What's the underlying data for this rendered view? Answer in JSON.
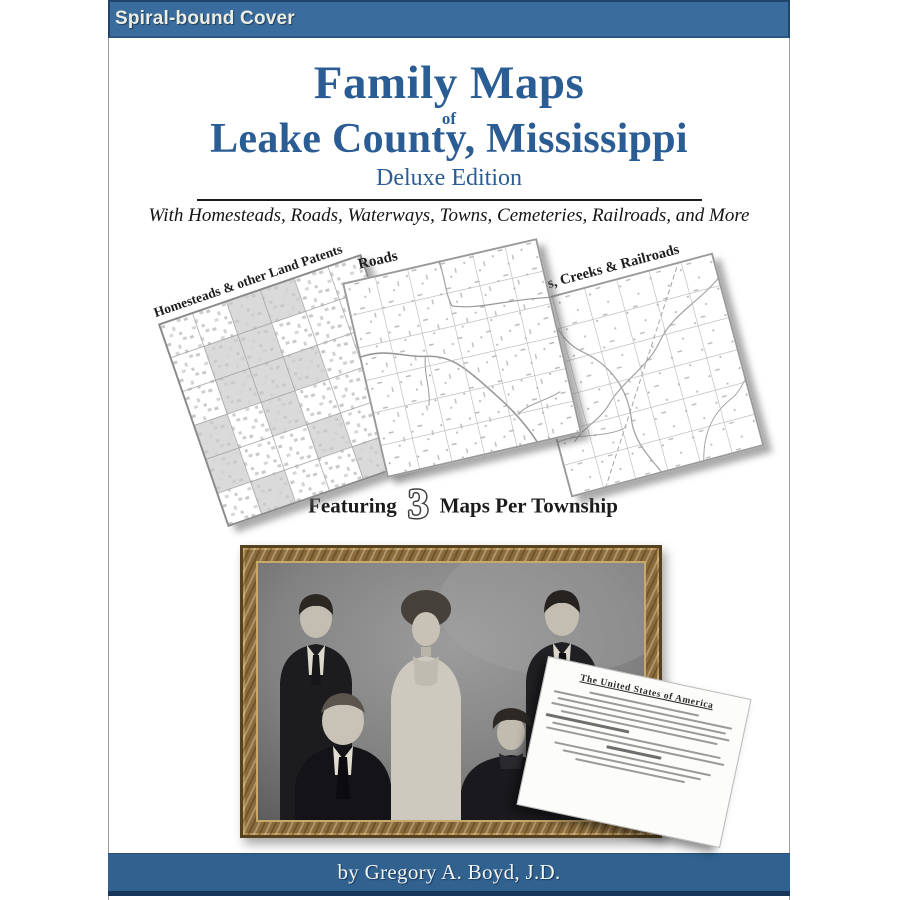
{
  "banner": {
    "label": "Spiral-bound Cover"
  },
  "cover": {
    "title": "Family Maps",
    "of": "of",
    "county": "Leake County, Mississippi",
    "edition": "Deluxe Edition",
    "tagline": "With Homesteads, Roads, Waterways, Towns, Cemeteries, Railroads, and More",
    "maps": [
      {
        "label": "Homesteads & other Land Patents"
      },
      {
        "label": "Roads"
      },
      {
        "label": "Rivers, Creeks & Railroads"
      }
    ],
    "featuring": {
      "prefix": "Featuring",
      "number": "3",
      "suffix": "Maps Per Township"
    },
    "document_header": "The United States of America",
    "byline": "by Gregory A. Boyd, J.D."
  },
  "colors": {
    "banner_blue": "#3a6d9e",
    "title_blue": "#2b5d95",
    "bar_blue": "#30618f",
    "frame_gold": "#8a6b3c"
  }
}
